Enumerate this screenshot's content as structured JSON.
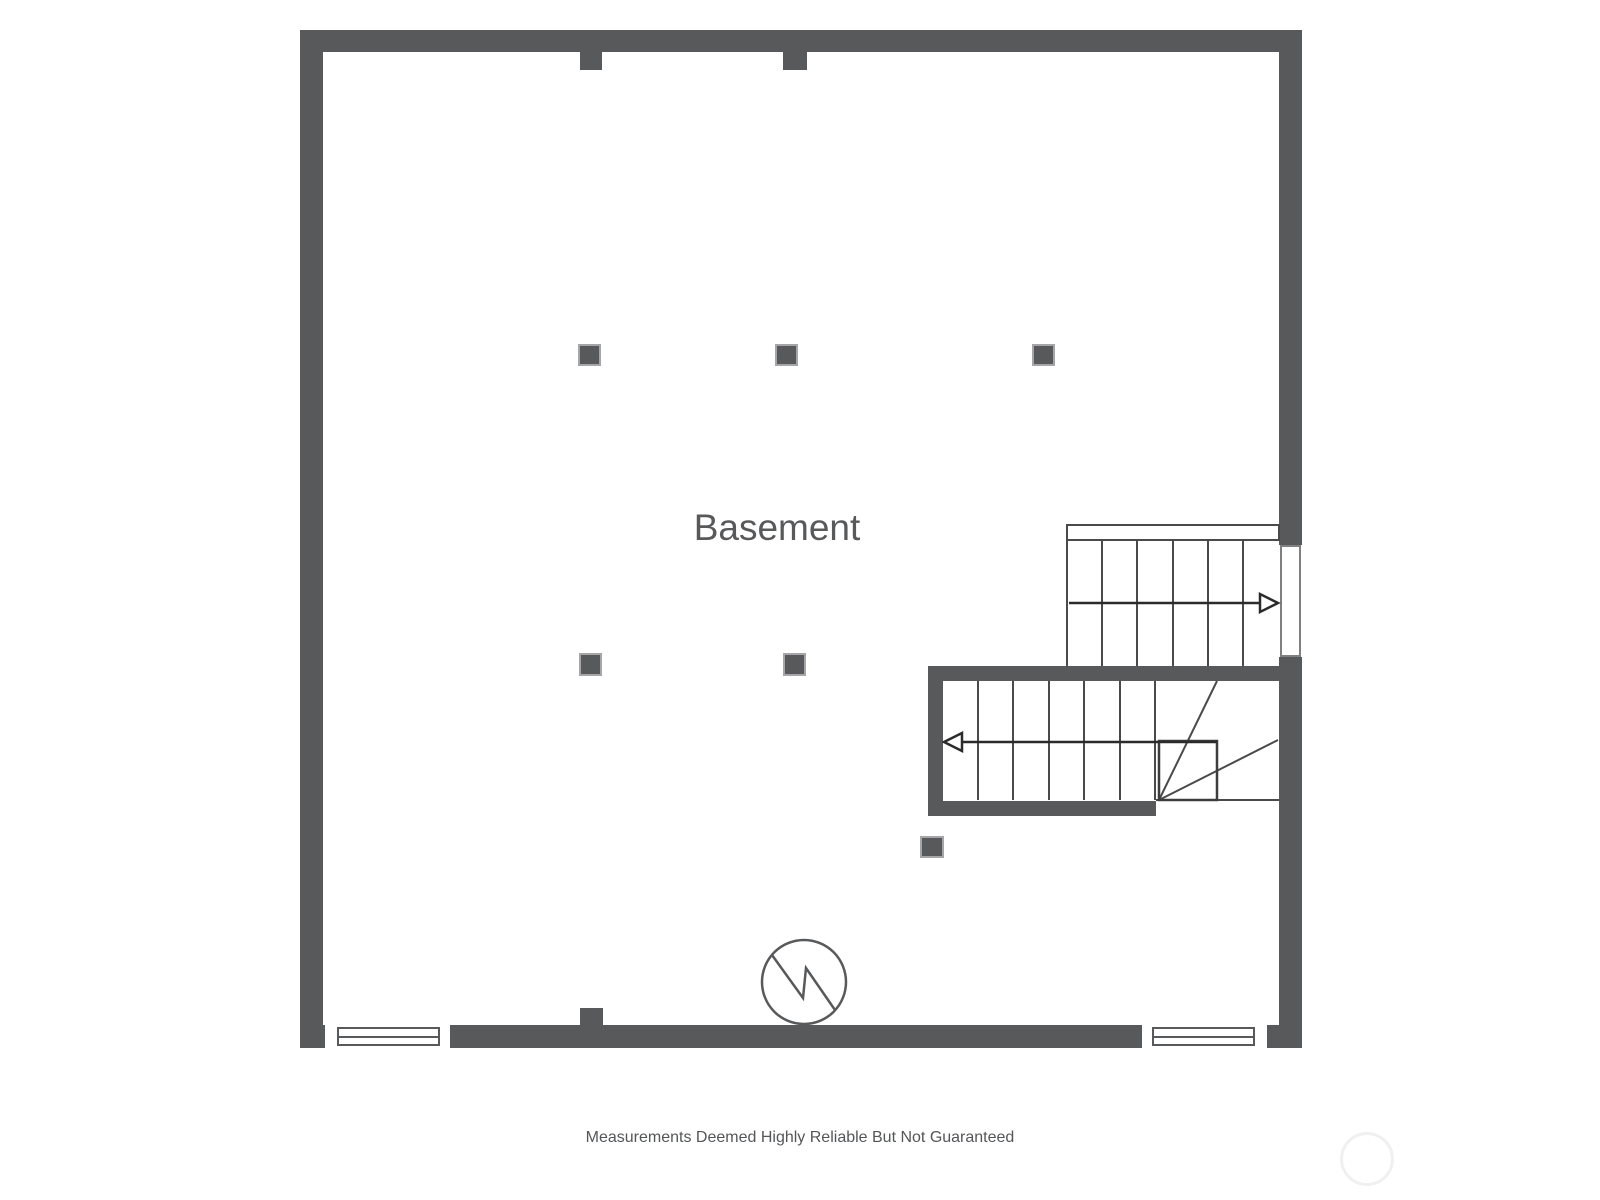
{
  "floor_plan": {
    "room_label": "Basement"
  },
  "footer": {
    "disclaimer": "Measurements Deemed Highly Reliable But Not Guaranteed"
  },
  "colors": {
    "wall": "#58595b",
    "stair_line": "#4a4a4b",
    "arrow": "#2b2b2b",
    "label_text": "#58595b",
    "disclaimer_text": "#555658",
    "post_border": "#a6a6a8",
    "opening_border": "#7f8082",
    "watermark": "#f0f0f0"
  },
  "symbols": {
    "stair_up_arrow": "arrow-right",
    "stair_down_arrow": "arrow-left",
    "utility_marker": "circle-with-zigzag",
    "watermark": "faint-circle"
  }
}
